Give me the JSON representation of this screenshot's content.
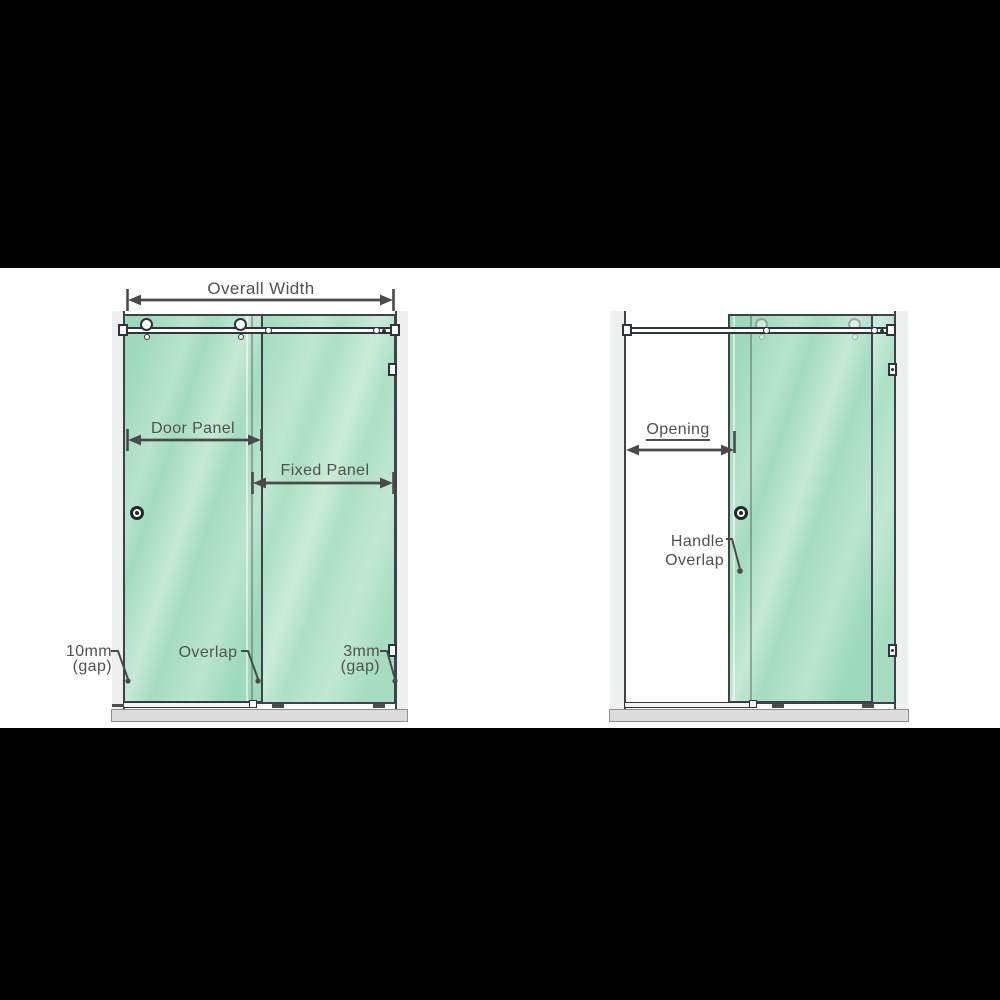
{
  "left_diagram": {
    "overall_width": "Overall Width",
    "door_panel": "Door Panel",
    "fixed_panel": "Fixed Panel",
    "gap_left": {
      "line1": "10mm",
      "line2": "(gap)"
    },
    "overlap": "Overlap",
    "gap_right": {
      "line1": "3mm",
      "line2": "(gap)"
    }
  },
  "right_diagram": {
    "opening": "Opening",
    "handle_overlap": {
      "line1": "Handle",
      "line2": "Overlap"
    }
  },
  "colors": {
    "glass_green": "#a6ddc0",
    "glass_border": "#3d4349",
    "dimension_lines": "#4a4a4a",
    "wall": "#eef0ef",
    "floor": "#dcdcdc",
    "letterbox_bars": "#000000"
  }
}
